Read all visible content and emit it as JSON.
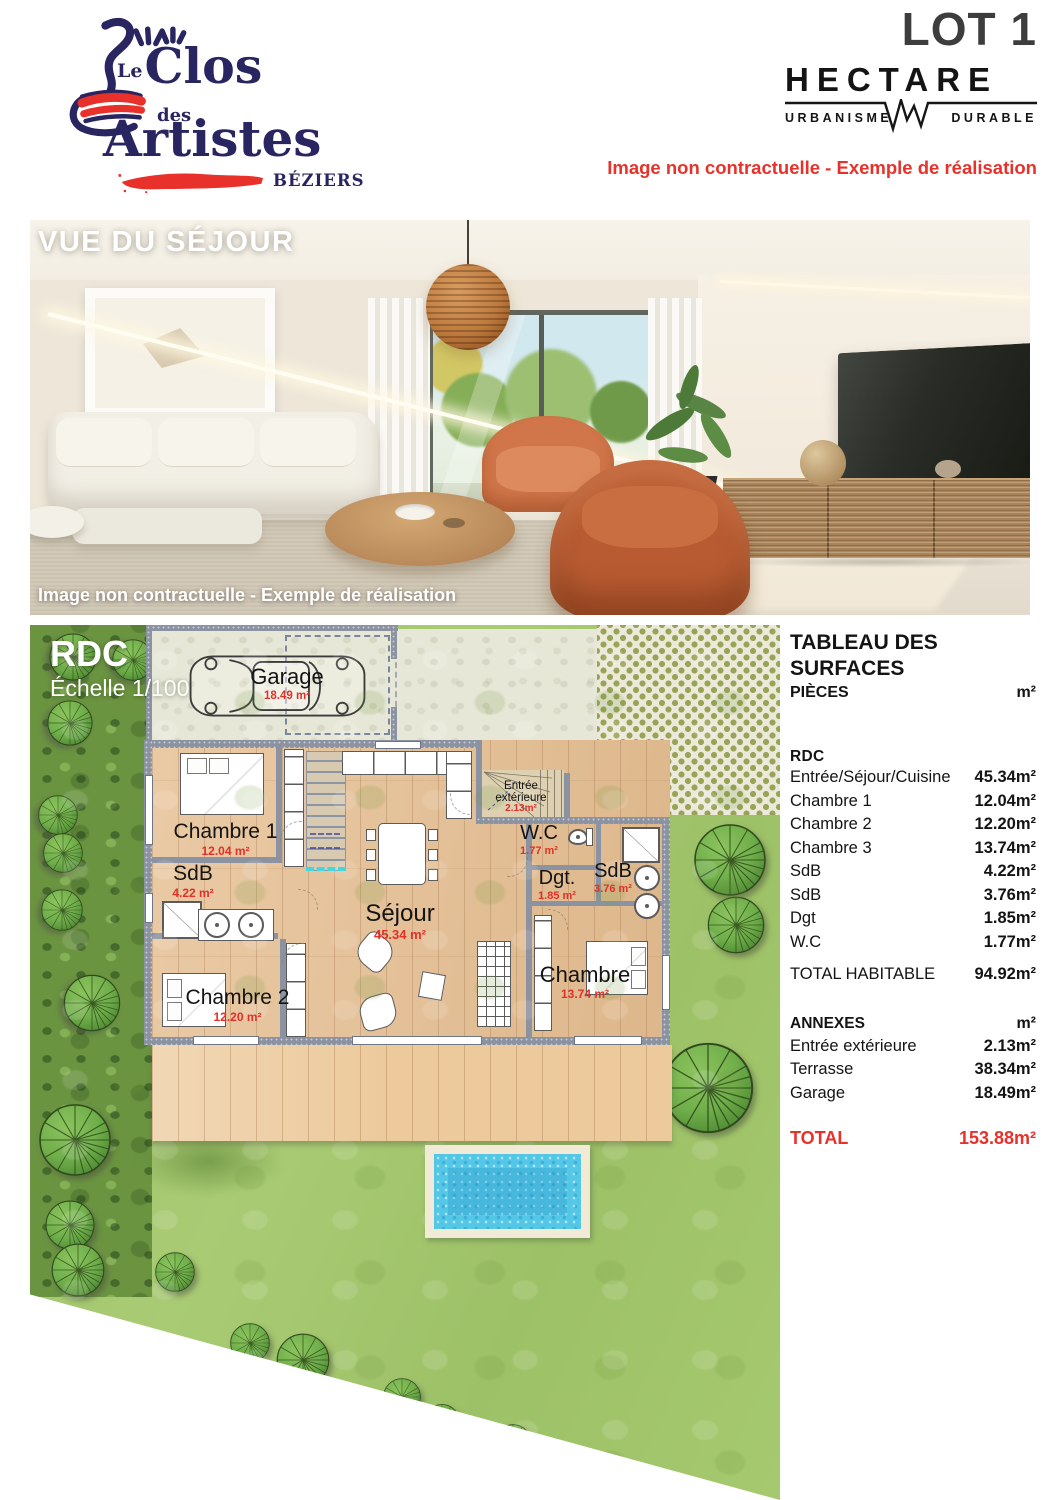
{
  "header": {
    "logo": {
      "le": "Le",
      "clos": "Clos",
      "des": "des",
      "artistes": "Artistes",
      "city": "BÉZIERS"
    },
    "lot": "LOT 1",
    "brand": {
      "name": "HECTARE",
      "left": "URBANISME",
      "right": "DURABLE"
    },
    "disclaimer": "Image non contractuelle - Exemple de réalisation"
  },
  "photo": {
    "title": "VUE DU SÉJOUR",
    "caption": "Image non contractuelle - Exemple de réalisation"
  },
  "plan": {
    "title": "RDC",
    "scale": "Échelle 1/100",
    "rooms": [
      {
        "name": "Garage",
        "area": "18.49 m²"
      },
      {
        "name": "Chambre 1",
        "area": "12.04 m²"
      },
      {
        "name": "SdB",
        "area": "4.22 m²"
      },
      {
        "name": "Séjour",
        "area": "45.34 m²"
      },
      {
        "name": "Chambre 2",
        "area": "12.20 m²"
      },
      {
        "name": "Entrée extérieure",
        "area": "2.13m²"
      },
      {
        "name": "W.C",
        "area": "1.77 m²"
      },
      {
        "name": "Dgt.",
        "area": "1.85 m²"
      },
      {
        "name": "SdB",
        "area": "3.76 m²"
      },
      {
        "name": "Chambre",
        "area": "13.74 m²"
      }
    ]
  },
  "table": {
    "title": "TABLEAU DES SURFACES",
    "columns": {
      "label": "PIÈCES",
      "unit": "m²"
    },
    "sections": {
      "rdc": "RDC",
      "annexes": "ANNEXES",
      "annexes_unit": "m²"
    },
    "rdc_rows": [
      {
        "label": "Entrée/Séjour/Cuisine",
        "value": "45.34m²"
      },
      {
        "label": "Chambre 1",
        "value": "12.04m²"
      },
      {
        "label": "Chambre 2",
        "value": "12.20m²"
      },
      {
        "label": "Chambre 3",
        "value": "13.74m²"
      },
      {
        "label": "SdB",
        "value": "4.22m²"
      },
      {
        "label": "SdB",
        "value": "3.76m²"
      },
      {
        "label": "Dgt",
        "value": "1.85m²"
      },
      {
        "label": "W.C",
        "value": "1.77m²"
      }
    ],
    "total_habitable": {
      "label": "TOTAL HABITABLE",
      "value": "94.92m²"
    },
    "annexes_rows": [
      {
        "label": "Entrée extérieure",
        "value": "2.13m²"
      },
      {
        "label": "Terrasse",
        "value": "38.34m²"
      },
      {
        "label": "Garage",
        "value": "18.49m²"
      }
    ],
    "total": {
      "label": "TOTAL",
      "value": "153.88m²"
    }
  },
  "colors": {
    "accent_red": "#E8312A",
    "brand_navy": "#292560",
    "title_gray": "#3D3D3D",
    "plan_area_red": "#E23028",
    "pool_blue": "#54C7E6",
    "grass_green": "#A6C873",
    "tree_green": "#6FAE4A",
    "wood_floor": "#E6C196"
  }
}
